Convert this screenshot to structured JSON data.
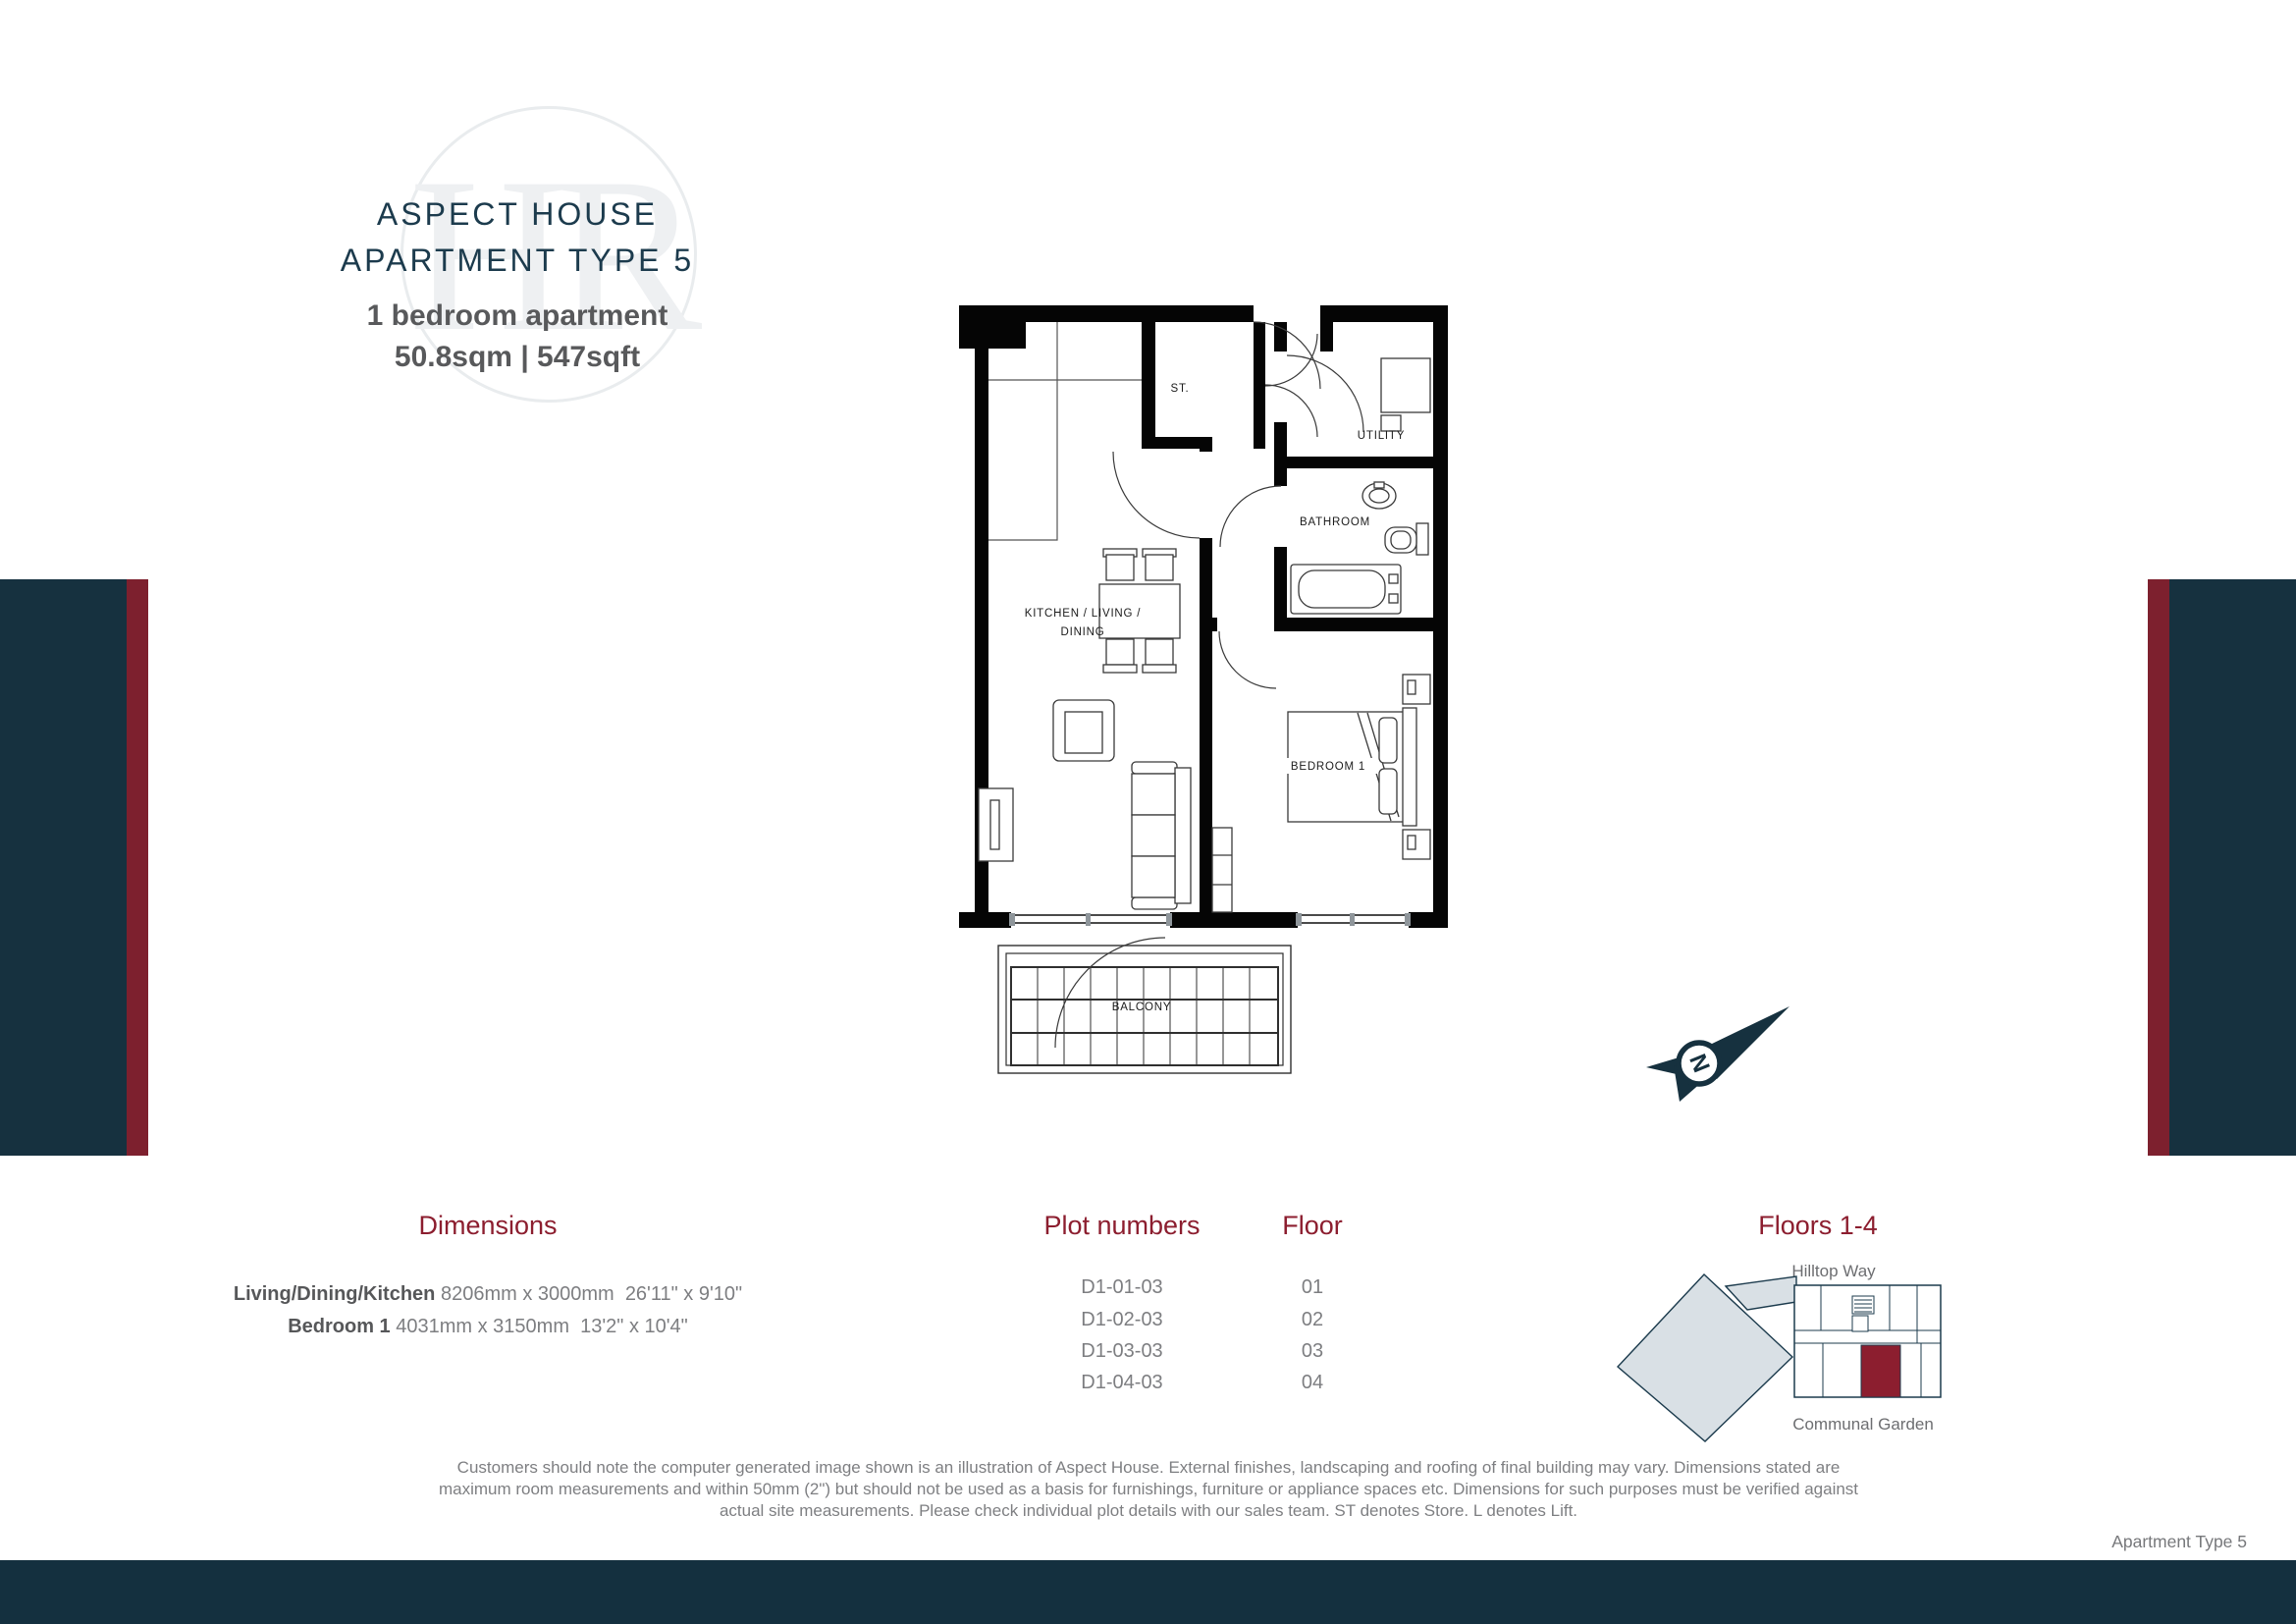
{
  "header": {
    "title_line1": "ASPECT HOUSE",
    "title_line2": "APARTMENT TYPE 5",
    "subtitle": "1 bedroom apartment",
    "area": "50.8sqm | 547sqft",
    "watermark_letters": "HR"
  },
  "floor_plan": {
    "labels": {
      "store": "ST.",
      "utility": "UTILITY",
      "bathroom": "BATHROOM",
      "kitchen_line1": "KITCHEN / LIVING /",
      "kitchen_line2": "DINING",
      "bedroom": "BEDROOM 1",
      "balcony": "BALCONY"
    }
  },
  "compass": {
    "letter": "N"
  },
  "dimensions": {
    "heading": "Dimensions",
    "rows": [
      {
        "name": "Living/Dining/Kitchen",
        "value": "8206mm x 3000mm  26'11\" x 9'10\""
      },
      {
        "name": "Bedroom 1",
        "value": "4031mm x 3150mm  13'2\" x 10'4\""
      }
    ]
  },
  "plots": {
    "heading": "Plot numbers",
    "floor_heading": "Floor",
    "rows": [
      {
        "plot": "D1-01-03",
        "floor": "01"
      },
      {
        "plot": "D1-02-03",
        "floor": "02"
      },
      {
        "plot": "D1-03-03",
        "floor": "03"
      },
      {
        "plot": "D1-04-03",
        "floor": "04"
      }
    ]
  },
  "site_plan": {
    "heading": "Floors 1-4",
    "street_label": "Hilltop Way",
    "garden_label": "Communal Garden"
  },
  "disclaimer": {
    "lines": [
      "Customers should note the computer generated image shown is an illustration of Aspect House. External finishes, landscaping and roofing of final building may vary. Dimensions stated are",
      "maximum room measurements and within 50mm (2\") but should not be used as a basis for furnishings, furniture or appliance spaces etc. Dimensions for such purposes must be verified against",
      "actual site measurements. Please check individual plot details with our sales team. ST denotes Store. L denotes Lift."
    ]
  },
  "footer": {
    "page_label": "Apartment Type 5"
  },
  "colors": {
    "navy": "#16313f",
    "red_stripe": "#7d202e",
    "maroon": "#8c1e2f",
    "title_navy": "#1c3b4d",
    "site_fill": "#d9e0e5"
  }
}
